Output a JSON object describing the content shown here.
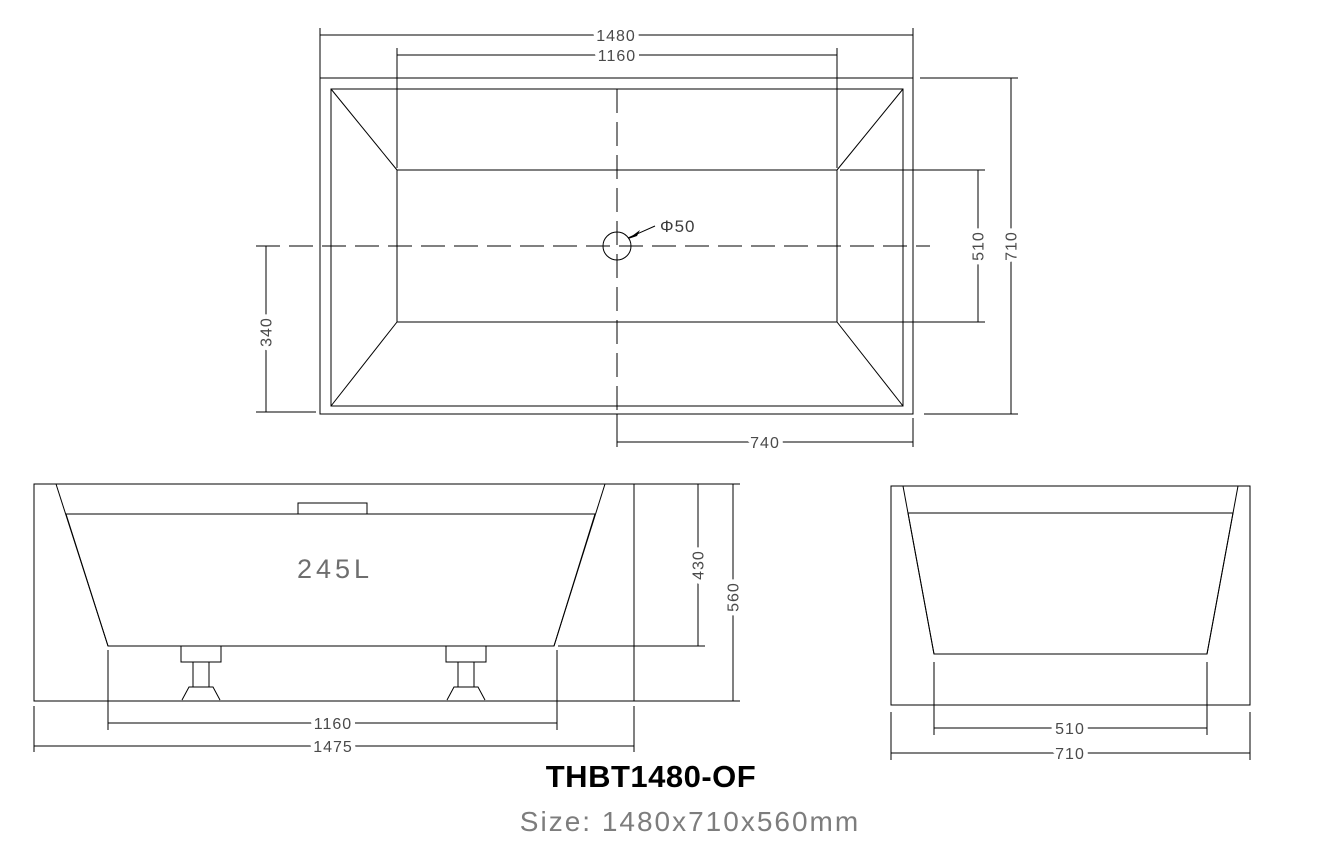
{
  "drawing": {
    "model": "THBT1480-OF",
    "size_label": "Size: 1480x710x560mm"
  },
  "colors": {
    "water_fill": "#8EDCF5",
    "drain_fill": "#1A1ACF",
    "line": "#000000",
    "dim_text": "#4A4A4A",
    "muted_text": "#7D7D7D"
  },
  "top_view": {
    "dim_overall_length": "1480",
    "dim_inner_length": "1160",
    "dim_inner_width": "510",
    "dim_overall_width": "710",
    "dim_centre_offset": "340",
    "dim_drain_offset": "740",
    "drain_label": "Φ50"
  },
  "front_view": {
    "capacity": "245L",
    "dim_inner_depth": "430",
    "dim_overall_height": "560",
    "dim_base_length": "1160",
    "dim_overall_length": "1475"
  },
  "side_view": {
    "dim_base_width": "510",
    "dim_overall_width": "710"
  }
}
